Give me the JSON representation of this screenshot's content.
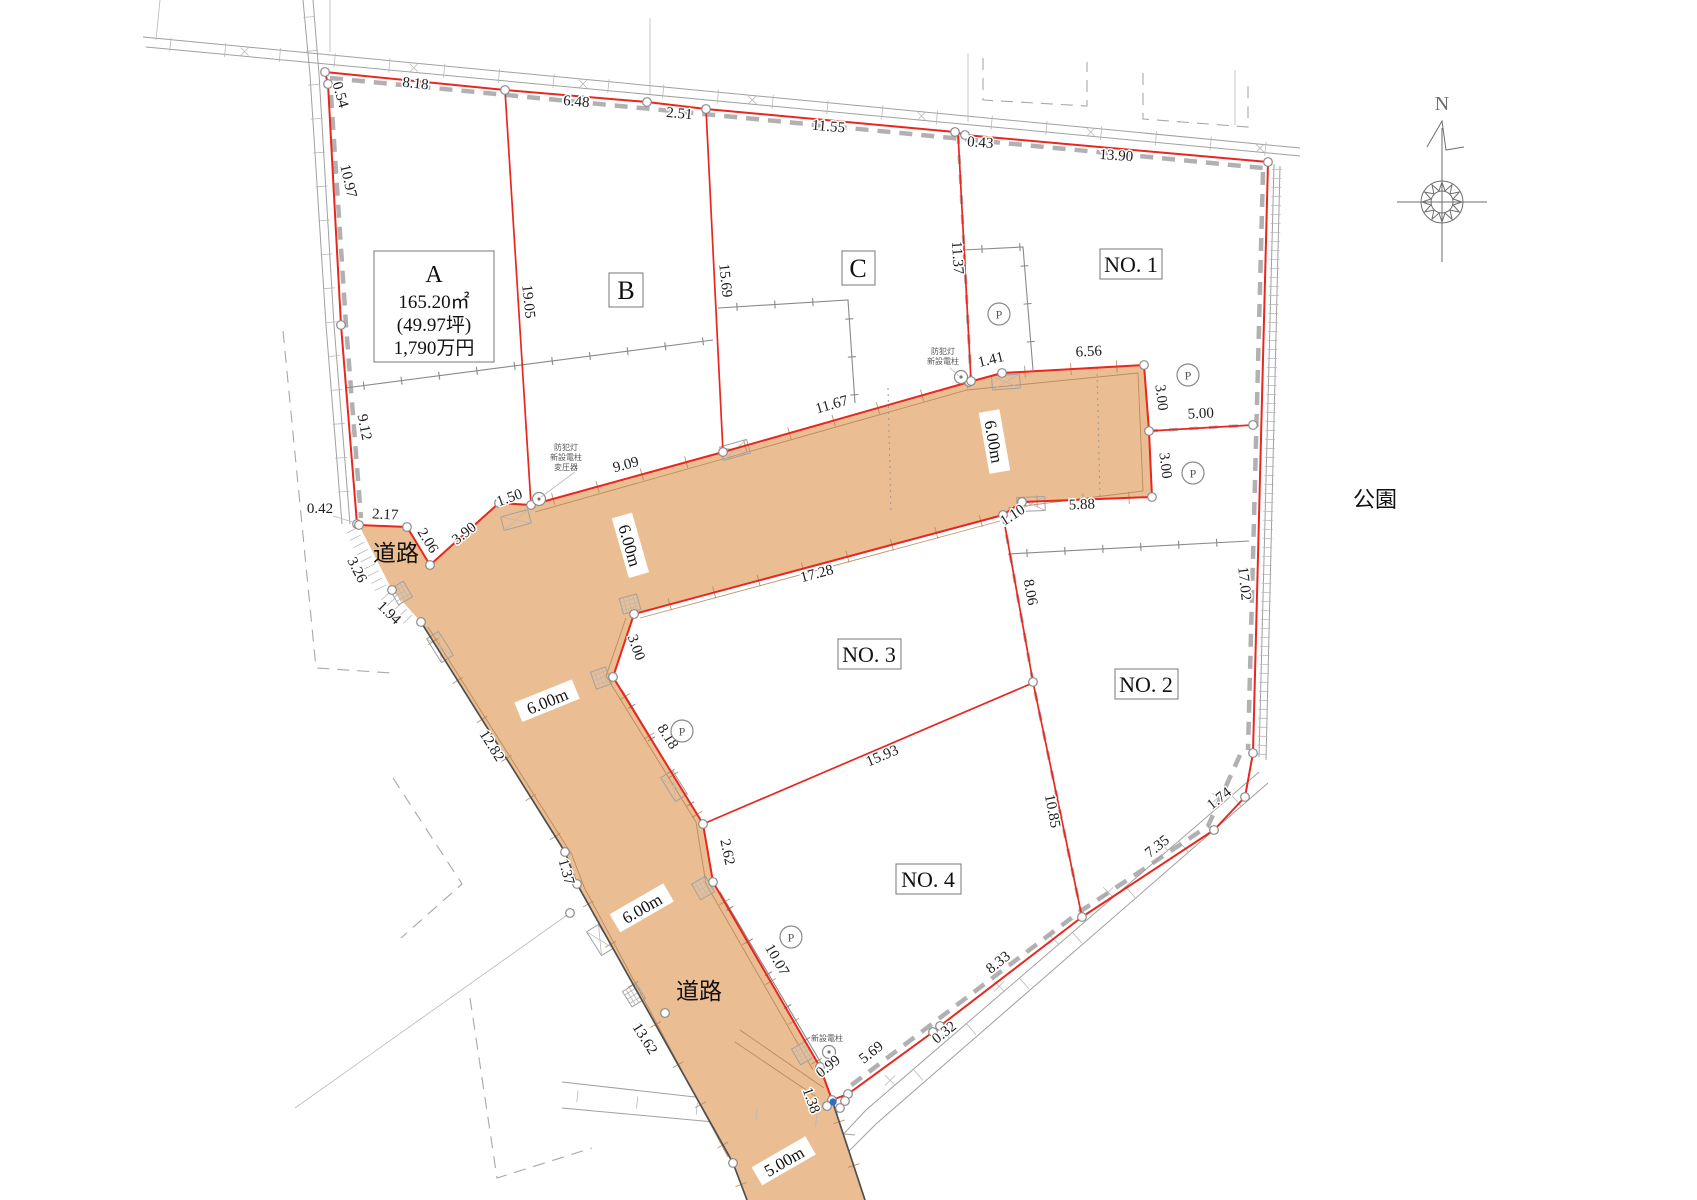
{
  "drawing": {
    "compass_north_label": "N",
    "park_label": "公園",
    "road_name_labels": [
      {
        "text": "道路",
        "x": 396,
        "y": 561
      },
      {
        "text": "道路",
        "x": 699,
        "y": 999
      }
    ],
    "road_width_labels": [
      {
        "text": "6.00m",
        "x": 628,
        "y": 546,
        "rot": 74
      },
      {
        "text": "6.00m",
        "x": 992,
        "y": 442,
        "rot": 80
      },
      {
        "text": "6.00m",
        "x": 548,
        "y": 703,
        "rot": -22
      },
      {
        "text": "6.00m",
        "x": 643,
        "y": 910,
        "rot": -30
      },
      {
        "text": "5.00m",
        "x": 785,
        "y": 1163,
        "rot": -30
      }
    ],
    "lots": [
      {
        "id": "A",
        "lines": [
          "A",
          "165.20㎡",
          "(49.97坪)",
          "1,790万円"
        ]
      },
      {
        "id": "B",
        "label": "B"
      },
      {
        "id": "C",
        "label": "C"
      },
      {
        "id": "NO.1",
        "label": "NO. 1"
      },
      {
        "id": "NO.2",
        "label": "NO. 2"
      },
      {
        "id": "NO.3",
        "label": "NO. 3"
      },
      {
        "id": "NO.4",
        "label": "NO. 4"
      }
    ],
    "parking_marks": {
      "label": "P",
      "positions": [
        [
          999,
          314
        ],
        [
          1188,
          375
        ],
        [
          1193,
          473
        ],
        [
          682,
          731
        ],
        [
          791,
          937
        ]
      ]
    },
    "utility_notes": [
      {
        "lines": [
          "防犯灯",
          "新設電柱",
          "変圧器"
        ],
        "x": 566,
        "y": 450
      },
      {
        "lines": [
          "防犯灯",
          "新設電柱"
        ],
        "x": 943,
        "y": 354
      },
      {
        "lines": [
          "新設電柱"
        ],
        "x": 827,
        "y": 1041
      }
    ],
    "dimensions": [
      {
        "t": "0.54",
        "x": 336,
        "y": 96,
        "r": 74
      },
      {
        "t": "8.18",
        "x": 415,
        "y": 88,
        "r": 6
      },
      {
        "t": "6.48",
        "x": 576,
        "y": 106,
        "r": 5
      },
      {
        "t": "2.51",
        "x": 679,
        "y": 118,
        "r": 5
      },
      {
        "t": "11.55",
        "x": 828,
        "y": 131,
        "r": 5
      },
      {
        "t": "0.43",
        "x": 980,
        "y": 147,
        "r": 4
      },
      {
        "t": "13.90",
        "x": 1116,
        "y": 160,
        "r": 4
      },
      {
        "t": "10.97",
        "x": 344,
        "y": 182,
        "r": 77
      },
      {
        "t": "19.05",
        "x": 524,
        "y": 302,
        "r": 84
      },
      {
        "t": "15.69",
        "x": 721,
        "y": 281,
        "r": 84
      },
      {
        "t": "11.37",
        "x": 953,
        "y": 258,
        "r": 86
      },
      {
        "t": "9.12",
        "x": 360,
        "y": 428,
        "r": 79
      },
      {
        "t": "0.42",
        "x": 320,
        "y": 513,
        "r": 0
      },
      {
        "t": "2.17",
        "x": 385,
        "y": 519,
        "r": 3
      },
      {
        "t": "2.06",
        "x": 424,
        "y": 543,
        "r": 58
      },
      {
        "t": "3.90",
        "x": 467,
        "y": 537,
        "r": -38
      },
      {
        "t": "1.50",
        "x": 511,
        "y": 502,
        "r": -20
      },
      {
        "t": "3.26",
        "x": 353,
        "y": 572,
        "r": 63
      },
      {
        "t": "1.94",
        "x": 386,
        "y": 616,
        "r": 44
      },
      {
        "t": "9.09",
        "x": 627,
        "y": 469,
        "r": -15
      },
      {
        "t": "11.67",
        "x": 833,
        "y": 409,
        "r": -16
      },
      {
        "t": "1.41",
        "x": 992,
        "y": 364,
        "r": -14
      },
      {
        "t": "6.56",
        "x": 1089,
        "y": 356,
        "r": -3
      },
      {
        "t": "3.00",
        "x": 1157,
        "y": 398,
        "r": 83
      },
      {
        "t": "5.00",
        "x": 1201,
        "y": 418,
        "r": -3
      },
      {
        "t": "3.00",
        "x": 1161,
        "y": 466,
        "r": 83
      },
      {
        "t": "5.88",
        "x": 1082,
        "y": 509,
        "r": -2
      },
      {
        "t": "1.10",
        "x": 1015,
        "y": 519,
        "r": -33
      },
      {
        "t": "17.28",
        "x": 818,
        "y": 578,
        "r": -15
      },
      {
        "t": "8.06",
        "x": 1026,
        "y": 593,
        "r": 80
      },
      {
        "t": "15.93",
        "x": 884,
        "y": 760,
        "r": -23
      },
      {
        "t": "10.85",
        "x": 1048,
        "y": 812,
        "r": 79
      },
      {
        "t": "3.00",
        "x": 632,
        "y": 649,
        "r": 70
      },
      {
        "t": "8.18",
        "x": 664,
        "y": 739,
        "r": 58
      },
      {
        "t": "2.62",
        "x": 723,
        "y": 853,
        "r": 78
      },
      {
        "t": "10.07",
        "x": 773,
        "y": 962,
        "r": 60
      },
      {
        "t": "1.38",
        "x": 807,
        "y": 1102,
        "r": 70
      },
      {
        "t": "0.99",
        "x": 831,
        "y": 1070,
        "r": -38
      },
      {
        "t": "5.69",
        "x": 874,
        "y": 1056,
        "r": -38
      },
      {
        "t": "0.32",
        "x": 947,
        "y": 1036,
        "r": -38
      },
      {
        "t": "8.33",
        "x": 1001,
        "y": 966,
        "r": -38
      },
      {
        "t": "7.35",
        "x": 1160,
        "y": 850,
        "r": -38
      },
      {
        "t": "1.74",
        "x": 1222,
        "y": 802,
        "r": -38
      },
      {
        "t": "17.02",
        "x": 1240,
        "y": 584,
        "r": 84
      },
      {
        "t": "12.82",
        "x": 488,
        "y": 748,
        "r": 58
      },
      {
        "t": "1.37",
        "x": 562,
        "y": 873,
        "r": 74
      },
      {
        "t": "13.62",
        "x": 641,
        "y": 1041,
        "r": 58
      }
    ],
    "colors": {
      "boundary_red": "#e8271f",
      "road_fill": "#ebbd92",
      "line_grey": "#9e9e9e",
      "marker_blue": "#2f6fc1"
    }
  }
}
